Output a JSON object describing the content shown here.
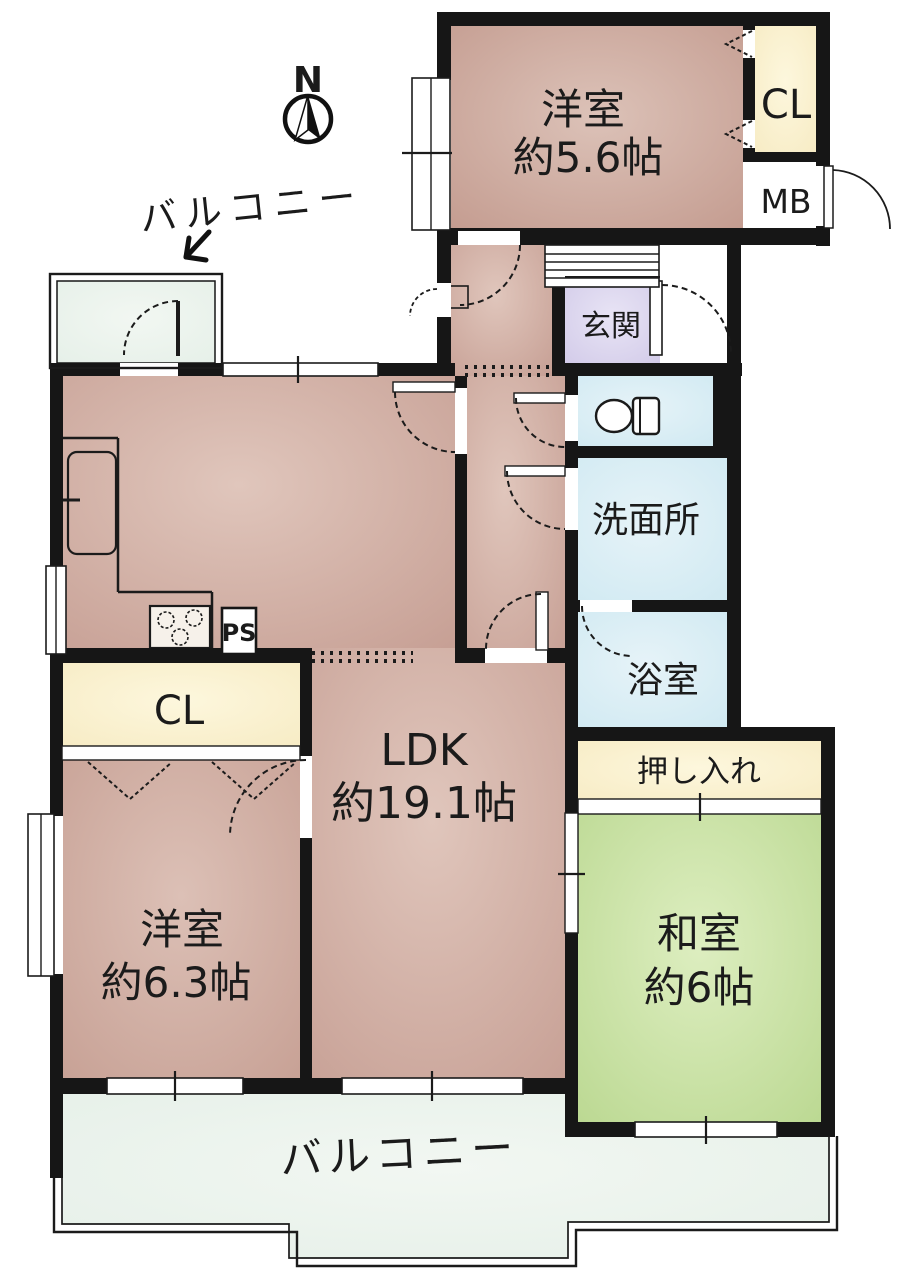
{
  "compass": {
    "label": "N"
  },
  "balcony_top": {
    "label": "バルコニー"
  },
  "balcony_bottom": {
    "label": "バルコニー"
  },
  "rooms": {
    "bedroom_top": {
      "name": "洋室",
      "size": "約5.6帖"
    },
    "closet_top": {
      "label": "CL"
    },
    "meter_box": {
      "label": "MB"
    },
    "entrance": {
      "label": "玄関"
    },
    "washroom": {
      "label": "洗面所"
    },
    "bathroom": {
      "label": "浴室"
    },
    "ldk": {
      "name": "LDK",
      "size": "約19.1帖"
    },
    "closet_left": {
      "label": "CL"
    },
    "pipe_space": {
      "label": "PS"
    },
    "bedroom_left": {
      "name": "洋室",
      "size": "約6.3帖"
    },
    "japanese_room": {
      "name": "和室",
      "size": "約6帖"
    },
    "oshiire": {
      "label": "押し入れ"
    }
  },
  "colors": {
    "wall": "#161616",
    "western_room": "#cdab9f",
    "ldk": "#d3b3a7",
    "tatami_room": "#c9e0a2",
    "closet": "#faf1d4",
    "wet_area": "#d9edf4",
    "entrance": "#d9d3ec",
    "balcony": "#edf3ee"
  }
}
